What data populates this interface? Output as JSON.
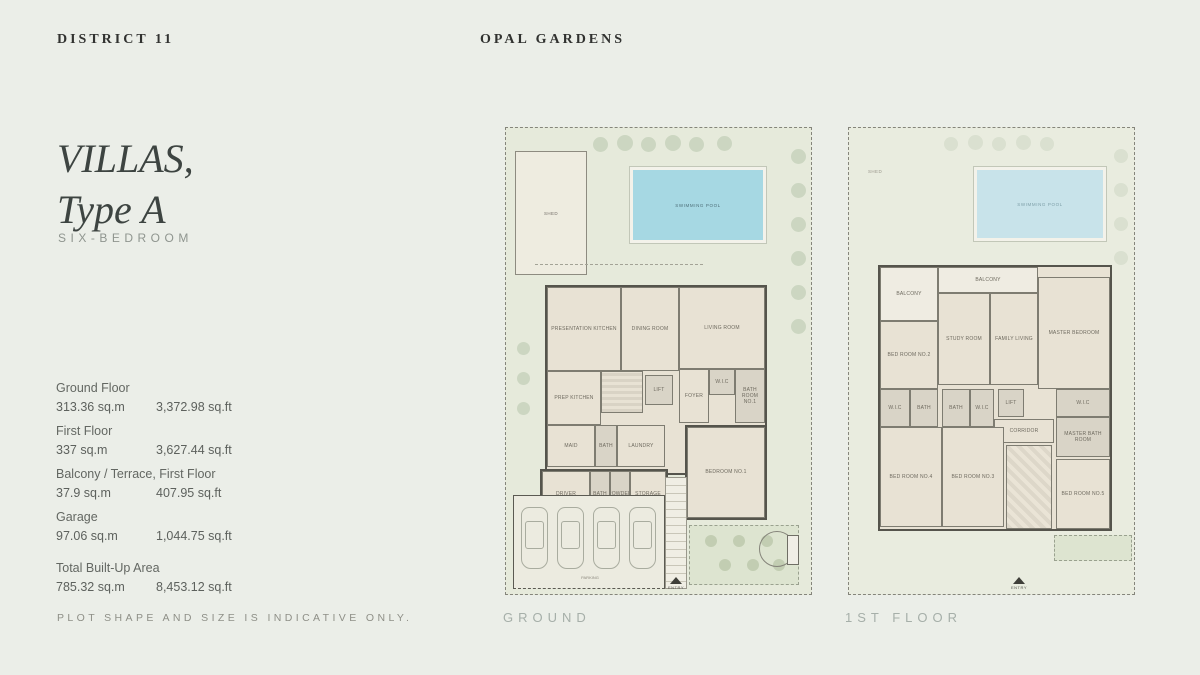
{
  "header": {
    "left": "DISTRICT 11",
    "center": "OPAL GARDENS"
  },
  "intro": {
    "title_line1": "VILLAS,",
    "title_line2": "Type A",
    "subtitle": "SIX-BEDROOM"
  },
  "areas": [
    {
      "label": "Ground Floor",
      "sqm": "313.36 sq.m",
      "sqft": "3,372.98 sq.ft"
    },
    {
      "label": "First Floor",
      "sqm": "337 sq.m",
      "sqft": "3,627.44 sq.ft"
    },
    {
      "label": "Balcony / Terrace, First Floor",
      "sqm": "37.9 sq.m",
      "sqft": "407.95 sq.ft"
    },
    {
      "label": "Garage",
      "sqm": "97.06 sq.m",
      "sqft": "1,044.75 sq.ft"
    },
    {
      "label": "Total Built-Up Area",
      "sqm": "785.32 sq.m",
      "sqft": "8,453.12 sq.ft"
    }
  ],
  "disclaimer": "PLOT SHAPE AND SIZE IS INDICATIVE ONLY.",
  "palette": {
    "background": "#ebeee8",
    "garden": "#e6eadb",
    "pool": "#a6d8e3",
    "building": "#e8e2d4",
    "walls": "#55544c"
  },
  "plans": {
    "ground": {
      "caption": "GROUND",
      "shed": "SHED",
      "pool": "SWIMMING POOL",
      "entry": "ENTRY",
      "rooms": {
        "presentation_kitchen": "PRESENTATION KITCHEN",
        "dining": "DINING ROOM",
        "living": "LIVING ROOM",
        "prep_kitchen": "PREP KITCHEN",
        "lift": "LIFT",
        "foyer": "FOYER",
        "wic": "W.I.C",
        "bath_room": "BATH ROOM NO.1",
        "maid": "MAID",
        "bath_a": "BATH",
        "laundry": "LAUNDRY",
        "driver": "DRIVER",
        "bath_b": "BATH",
        "powder": "POWDER",
        "storage": "STORAGE",
        "bedroom1": "BEDROOM NO.1",
        "parking": "PARKING"
      }
    },
    "first": {
      "caption": "1ST FLOOR",
      "shed": "SHED",
      "pool": "SWIMMING POOL",
      "entry": "ENTRY",
      "rooms": {
        "balcony_left": "BALCONY",
        "balcony_mid": "BALCONY",
        "bedroom2": "BED ROOM NO.2",
        "study": "STUDY ROOM",
        "family_living": "FAMILY LIVING",
        "master_bedroom": "MASTER BEDROOM",
        "wic_left": "W.I.C",
        "bath_left": "BATH",
        "bath_c": "BATH",
        "wic_c": "W.I.C",
        "lift": "LIFT",
        "corridor": "CORRIDOR",
        "wic_right": "W.I.C",
        "master_bath": "MASTER BATH ROOM",
        "bedroom4": "BED ROOM NO.4",
        "bedroom3": "BED ROOM NO.3",
        "bedroom5": "BED ROOM NO.5"
      }
    }
  }
}
